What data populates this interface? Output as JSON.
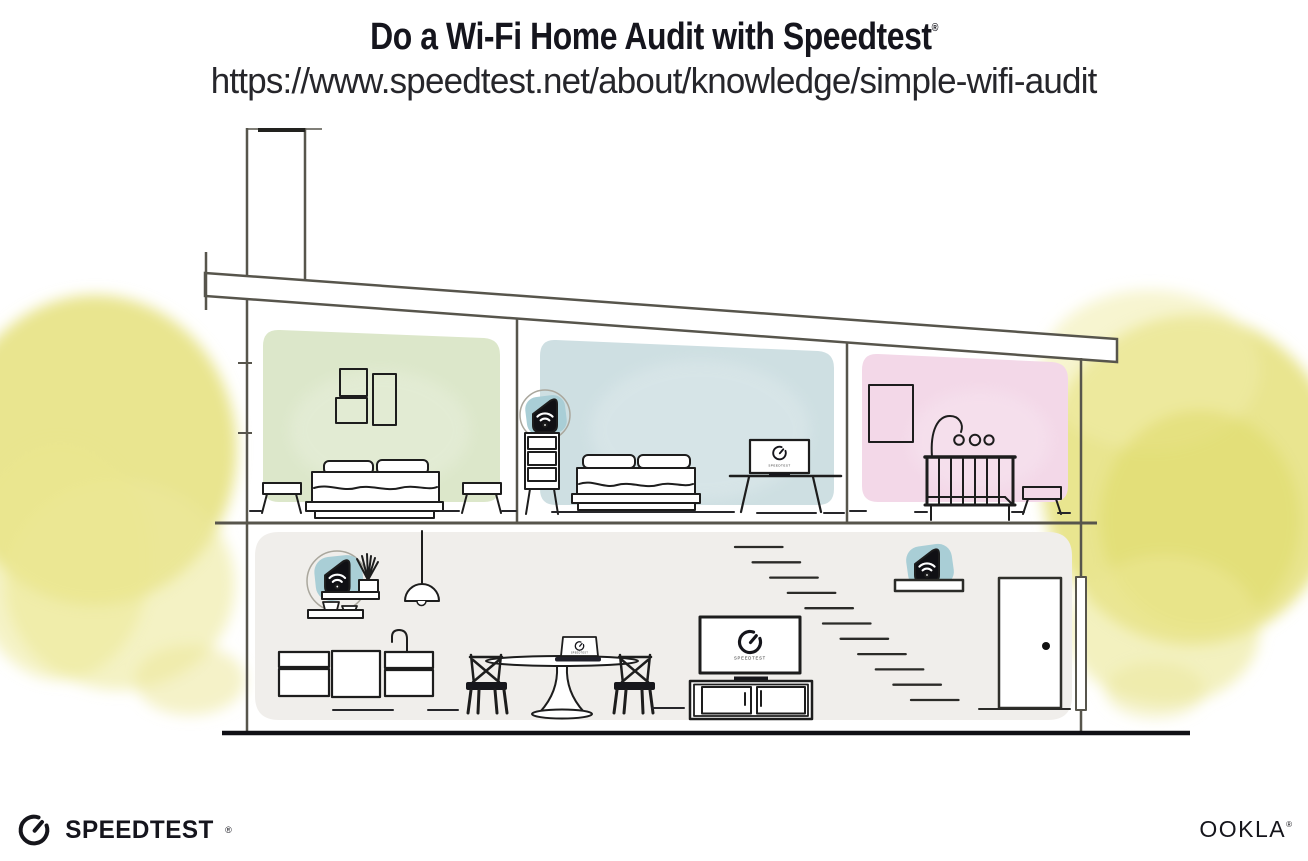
{
  "header": {
    "title": "Do a Wi-Fi Home Audit with Speedtest",
    "registered_mark": "®",
    "url": "https://www.speedtest.net/about/knowledge/simple-wifi-audit"
  },
  "footer": {
    "speedtest_wordmark": "SPEEDTEST",
    "speedtest_registered": "®",
    "ookla_wordmark": "OOKLA",
    "ookla_registered": "®"
  },
  "illustration": {
    "tv_screen_label": "SPEEDTEST",
    "monitor_screen_label": "SPEEDTEST",
    "laptop_screen_label": "SPEEDTEST",
    "icons": [
      "wifi-icon",
      "speedtest-gauge-icon"
    ],
    "colors": {
      "room_green": "#dce7ca",
      "room_blue": "#cedfe2",
      "room_pink": "#f3d8e8",
      "ground_floor": "#f0eeeb",
      "wifi_halo_teal": "#a9ced6",
      "device_black": "#101014",
      "outline_gray": "#57554c",
      "ink_black": "#1d1d1d",
      "foliage_yellow": "#e5e17b"
    }
  }
}
